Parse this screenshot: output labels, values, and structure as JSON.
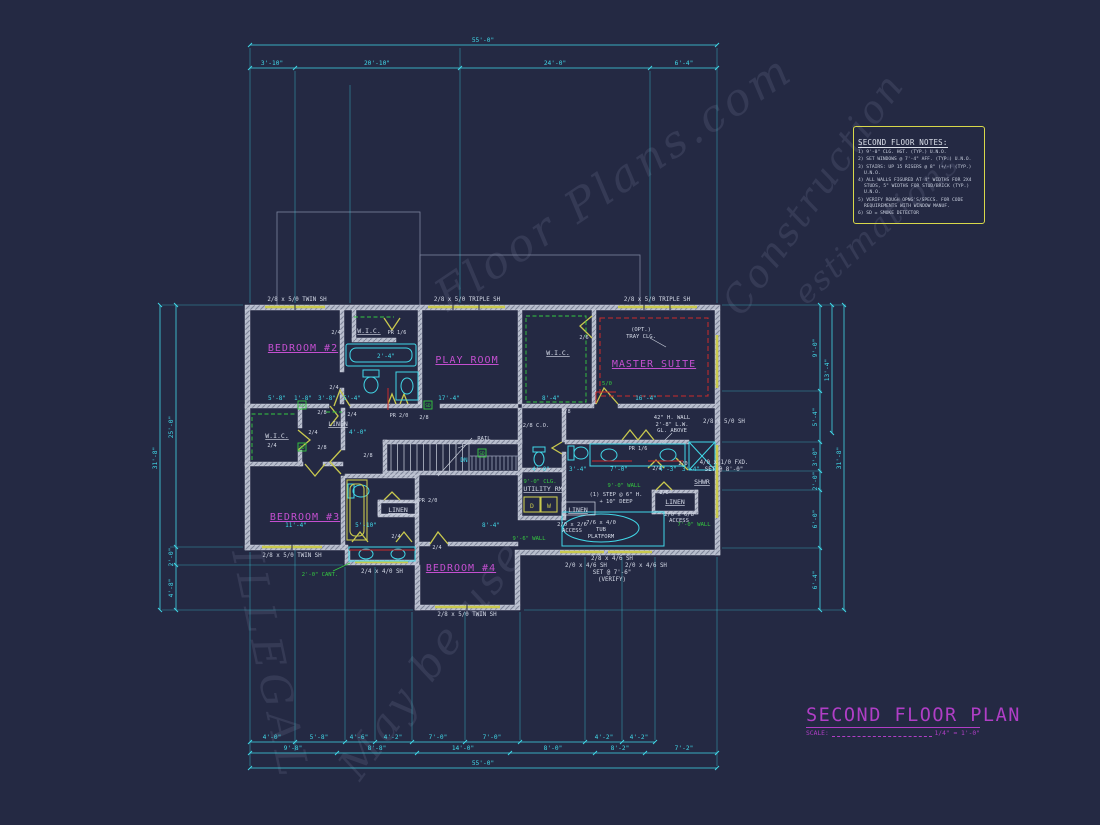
{
  "colors": {
    "background": "#242943",
    "cyan": "#41d8e8",
    "yellow": "#c9c94e",
    "magenta": "#c44fd0",
    "title_magenta": "#b03ec6",
    "green": "#35c940",
    "red": "#cc2b2b",
    "wall": "#b7bdcc",
    "white": "#d6dbe8",
    "watermark": "#8d96b5",
    "notes_border": "#d8d84a"
  },
  "title_block": {
    "title": "SECOND FLOOR PLAN",
    "scale_label": "SCALE:",
    "scale_value": "1/4\" = 1'-0\""
  },
  "notes_box": {
    "title": "SECOND FLOOR NOTES:",
    "items": [
      "1) 9'-0\" CLG. HGT. (TYP.) U.N.O.",
      "2) SET WINDOWS @ 7'-4\" AFF. (TYP.) U.N.O.",
      "3) STAIRS: UP 15 RISERS @ 8\" (+/-) (TYP.) U.N.O.",
      "4) ALL WALLS FIGURED AT 4\" WIDTHS FOR 2X4 STUDS, 5\" WIDTHS FOR STUD/BRICK (TYP.) U.N.O.",
      "5) VERIFY ROUGH OPNG'S/SPECS. FOR CODE REQUIREMENTS WITH WINDOW MANUF.",
      "6) SD = SMOKE DETECTOR"
    ]
  },
  "rooms": {
    "bedroom2": "BEDROOM #2",
    "playroom": "PLAY ROOM",
    "master": "MASTER SUITE",
    "bedroom3": "BEDROOM #3",
    "bedroom4": "BEDROOM #4",
    "wic": "W.I.C.",
    "linen": "LINEN",
    "utility": "UTILITY RM",
    "shwr": "SHWR"
  },
  "windows": {
    "twin": "2/8 x 5/0 TWIN SH",
    "triple": "2/8 x 5/0 TRIPLE SH",
    "sh2440": "2/4 x 4/0 SH",
    "sh2850": "2/8 x 5/0 SH",
    "sh2846": "2/8 x 4/6 SH",
    "sh2046": "2/0 x 4/6 SH",
    "set76": "SET @ 7'-6\"",
    "verify": "(VERIFY)",
    "fxd": "4/0 x 1/0 FXD.",
    "set80": "SET @ 8'-0\""
  },
  "doors": {
    "d24": "2/4",
    "d28": "2/8",
    "d20": "2/0",
    "d26": "2/6",
    "d50": "5/0",
    "pr16": "PR 1/6",
    "pr20": "PR 2/0"
  },
  "ann": {
    "tray1": "(OPT.)",
    "tray2": "TRAY CLG.",
    "rail": "RAIL",
    "dn": "DN",
    "sd": "SD",
    "co": "2/8 C.O.",
    "step1": "(1) STEP @ 6\" H.",
    "step2": "+ 10\" DEEP",
    "tub1": "7/6 x 4/0",
    "tub2": "TUB",
    "tub3": "PLATFORM",
    "access1a": "2/0 x 2/6",
    "access2a": "2/0 x 6/8",
    "access_b": "ACCESS",
    "hw1": "42\" H. WALL",
    "hw2": "2'-8\" L.W.",
    "hw3": "GL. ABOVE",
    "clg90": "9'-0\" CLG.",
    "wall90": "9'-0\" WALL",
    "wall96": "9'-6\" WALL",
    "wall70": "7'-0\" WALL",
    "cant": "2'-0\" CANT.",
    "dryer": "D",
    "washer": "W"
  },
  "dims": {
    "top_overall": "55'-0\"",
    "top_segments": [
      "3'-10\"",
      "20'-10\"",
      "24'-0\"",
      "6'-4\""
    ],
    "bottom_row1": [
      "4'-0\"",
      "5'-8\"",
      "4'-6\"",
      "4'-2\"",
      "7'-0\"",
      "7'-0\"",
      "4'-2\"",
      "4'-2\""
    ],
    "bottom_row2": [
      "9'-8\"",
      "8'-8\"",
      "14'-0\"",
      "8'-0\"",
      "8'-2\"",
      "7'-2\""
    ],
    "bottom_overall": "55'-0\"",
    "left": [
      "31'-8\"",
      "25'-0\"",
      "2'-0\"",
      "4'-8\""
    ],
    "right": [
      "9'-0\"",
      "5'-4\"",
      "3'-0\"",
      "2'-0\"",
      "6'-0\"",
      "6'-4\"",
      "13'-4\"",
      "31'-8\""
    ],
    "interior": [
      "5'-8\"",
      "1'-8\"",
      "3'-8\"",
      "5'-4\"",
      "2'-4\"",
      "17'-4\"",
      "8'-4\"",
      "16'-4\"",
      "11'-4\"",
      "5'-10\"",
      "8'-4\"",
      "4'-0\"",
      "4'-0\"",
      "3'-4\"",
      "7'-0\"",
      "4'-3\"",
      "3'-4\""
    ]
  },
  "watermark": {
    "fragments": [
      "Floor Plans.com",
      "Construction",
      "estimations",
      "ILLEGAL",
      "May be use"
    ]
  }
}
